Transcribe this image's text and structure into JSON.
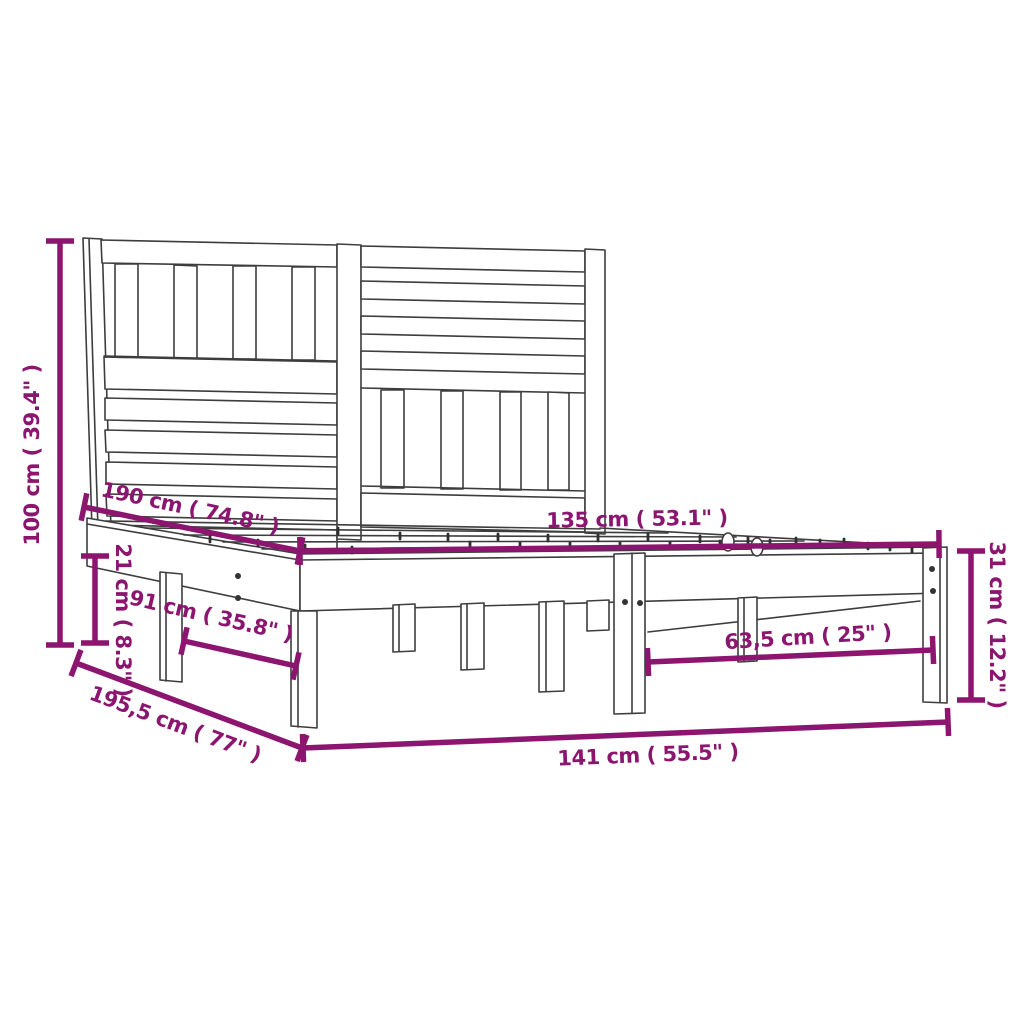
{
  "diagram": {
    "kind": "product-dimension-diagram",
    "subject": "wooden bed frame with slatted headboard",
    "accent_color": "#8C156F",
    "line_color": "#3d3d3d",
    "background_color": "#ffffff",
    "dimensions": [
      {
        "id": "overall-height",
        "label": "100 cm ( 39.4\" )",
        "x1": 60,
        "y1": 241,
        "x2": 60,
        "y2": 645,
        "lx": 33,
        "ly": 455,
        "rot": -90
      },
      {
        "id": "bed-length",
        "label": "190 cm ( 74.8\" )",
        "x1": 84,
        "y1": 507,
        "x2": 300,
        "y2": 551,
        "lx": 190,
        "ly": 509,
        "rot": 12
      },
      {
        "id": "side-rail-height",
        "label": "21 cm ( 8.3\" )",
        "x1": 95,
        "y1": 556,
        "x2": 95,
        "y2": 643,
        "lx": 122,
        "ly": 620,
        "rot": 90
      },
      {
        "id": "leg-span-left",
        "label": "91 cm ( 35.8\" )",
        "x1": 184,
        "y1": 641,
        "x2": 296,
        "y2": 666,
        "lx": 211,
        "ly": 617,
        "rot": 13
      },
      {
        "id": "overall-length",
        "label": "195,5 cm ( 77\" )",
        "x1": 76,
        "y1": 663,
        "x2": 302,
        "y2": 748,
        "lx": 175,
        "ly": 725,
        "rot": 20.5
      },
      {
        "id": "bed-width",
        "label": "135 cm ( 53.1\" )",
        "x1": 300,
        "y1": 551,
        "x2": 939,
        "y2": 544,
        "lx": 637,
        "ly": 520,
        "rot": -1
      },
      {
        "id": "foot-end-height",
        "label": "31 cm ( 12.2\" )",
        "x1": 971,
        "y1": 551,
        "x2": 971,
        "y2": 700,
        "lx": 996,
        "ly": 625,
        "rot": 90
      },
      {
        "id": "leg-spacing-front",
        "label": "63,5 cm ( 25\" )",
        "x1": 648,
        "y1": 662,
        "x2": 933,
        "y2": 650,
        "lx": 808,
        "ly": 638,
        "rot": -3.5
      },
      {
        "id": "overall-width",
        "label": "141 cm ( 55.5\" )",
        "x1": 303,
        "y1": 748,
        "x2": 948,
        "y2": 722,
        "lx": 648,
        "ly": 756,
        "rot": -2.3
      }
    ]
  }
}
